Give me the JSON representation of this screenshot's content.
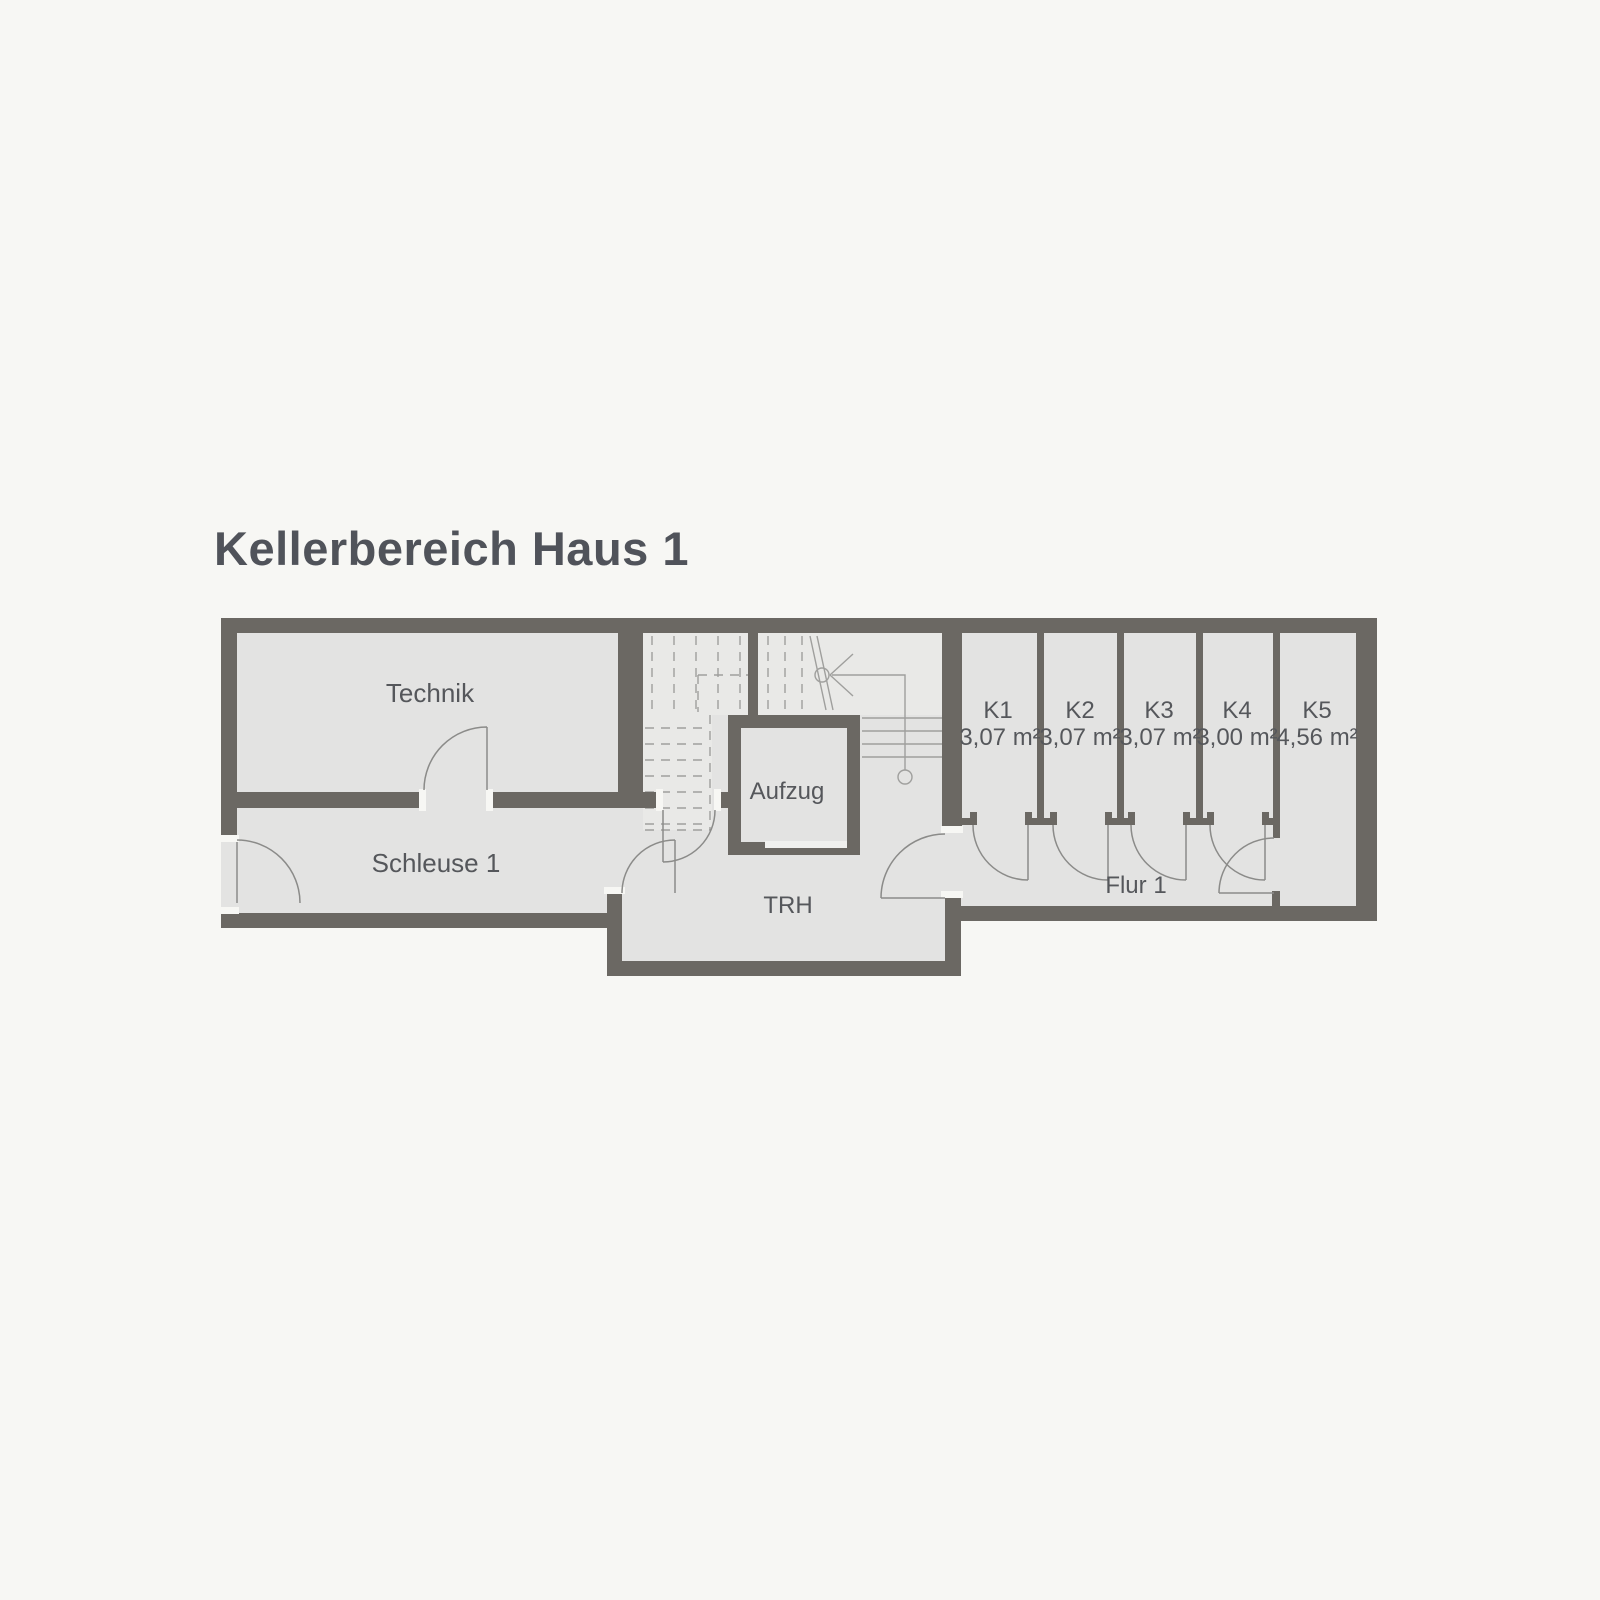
{
  "title": "Kellerbereich Haus 1",
  "rooms": {
    "technik": {
      "label": "Technik"
    },
    "schleuse": {
      "label": "Schleuse 1"
    },
    "aufzug": {
      "label": "Aufzug"
    },
    "trh": {
      "label": "TRH"
    },
    "flur": {
      "label": "Flur 1"
    },
    "storage": [
      {
        "label": "K1",
        "area": "3,07 m²"
      },
      {
        "label": "K2",
        "area": "3,07 m²"
      },
      {
        "label": "K3",
        "area": "3,07 m²"
      },
      {
        "label": "K4",
        "area": "3,00 m²"
      },
      {
        "label": "K5",
        "area": "4,56 m²"
      }
    ]
  },
  "colors": {
    "wall": "#6b6863",
    "room_fill": "#e3e3e2",
    "background": "#f7f7f4",
    "stair_line": "#9f9f9d",
    "text": "#55575b"
  }
}
